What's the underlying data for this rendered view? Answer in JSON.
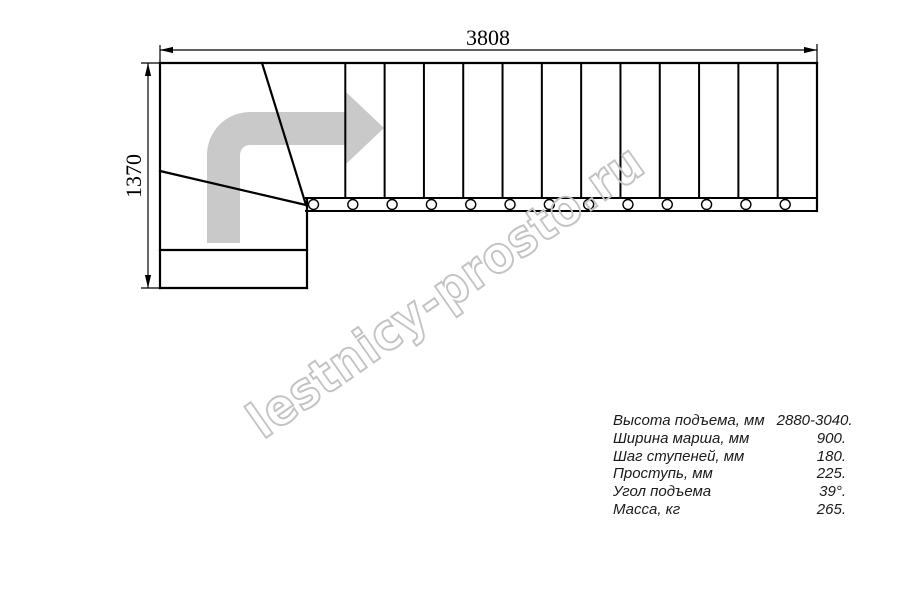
{
  "drawing": {
    "type": "staircase-plan-top-view",
    "dimensions": {
      "total_length_mm": "3808",
      "total_width_mm": "1370"
    },
    "flight": {
      "straight_steps": 13,
      "winder_steps": 2,
      "direction": "turn-right-then-straight"
    },
    "colors": {
      "line": "#000000",
      "direction_arrow": "#c9c9c9",
      "watermark": "#c3c3c3"
    }
  },
  "watermark": {
    "text": "lestnicy-prosto.ru"
  },
  "specs": {
    "rows": [
      {
        "label": "Высота подъема, мм",
        "value": "2880-3040."
      },
      {
        "label": "Ширина марша, мм",
        "value": "900."
      },
      {
        "label": "Шаг ступеней, мм",
        "value": "180."
      },
      {
        "label": "Проступь, мм",
        "value": "225."
      },
      {
        "label": "Угол подъема",
        "value": "39°."
      },
      {
        "label": "Масса, кг",
        "value": "265."
      }
    ]
  }
}
